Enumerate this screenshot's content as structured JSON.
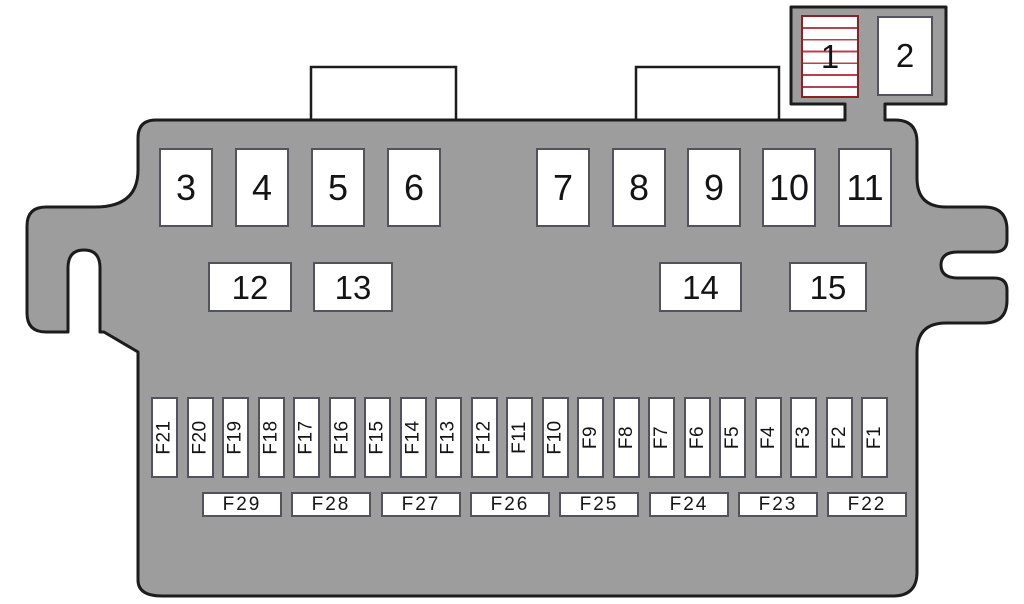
{
  "diagram_title": "Fuse box diagram",
  "colors": {
    "body_fill": "#9d9d9d",
    "outline": "#1c1c1c",
    "slot_border": "#53535f",
    "slot_fill": "#ffffff",
    "label_color": "#141414",
    "relay1_border": "#8e1f24",
    "relay1_stripe": "#b5444a"
  },
  "top_unit": {
    "relays": [
      {
        "label": "1",
        "striped": true
      },
      {
        "label": "2",
        "striped": false
      }
    ]
  },
  "relay_slots_row1": [
    "3",
    "4",
    "5",
    "6",
    "7",
    "8",
    "9",
    "10",
    "11"
  ],
  "relay_slots_row2": [
    "12",
    "13",
    "14",
    "15"
  ],
  "fuse_strip_labels": [
    "F21",
    "F20",
    "F19",
    "F18",
    "F17",
    "F16",
    "F15",
    "F14",
    "F13",
    "F12",
    "F11",
    "F10",
    "F9",
    "F8",
    "F7",
    "F6",
    "F5",
    "F4",
    "F3",
    "F2",
    "F1"
  ],
  "fuse_group_labels": [
    "F29",
    "F28",
    "F27",
    "F26",
    "F25",
    "F24",
    "F23",
    "F22"
  ]
}
